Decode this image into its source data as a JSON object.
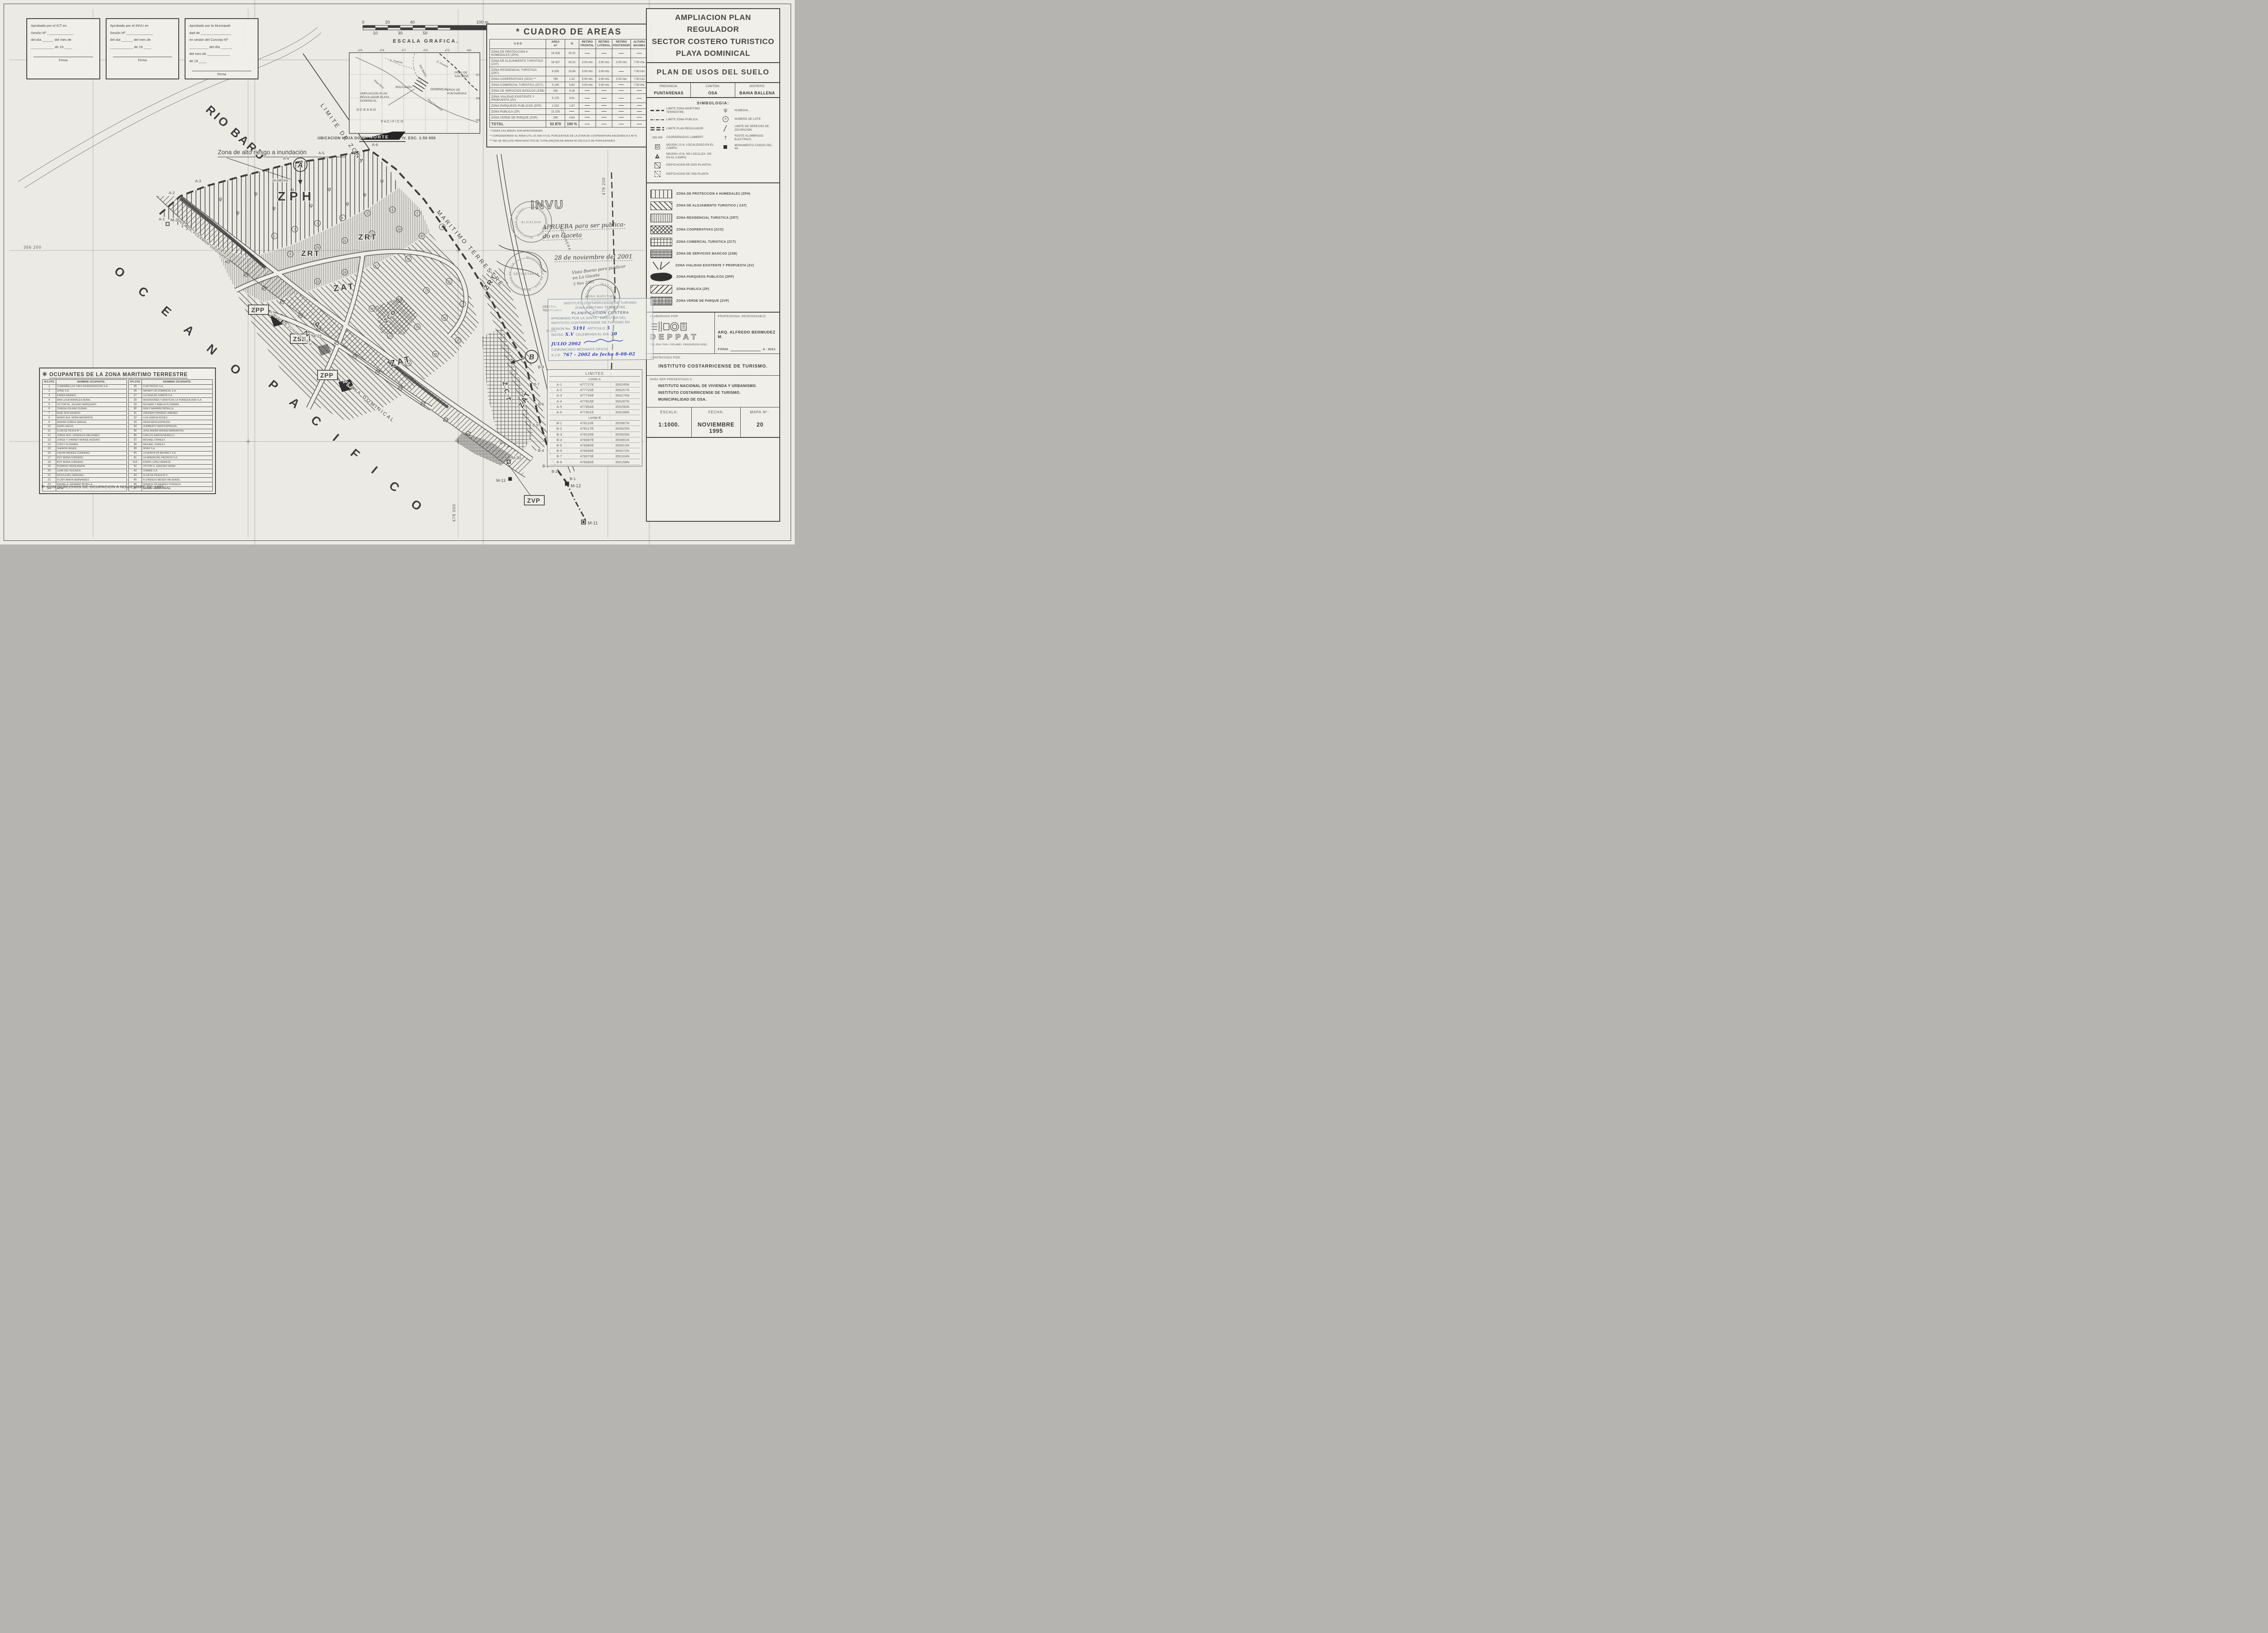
{
  "approval_boxes": [
    {
      "lines": [
        "Aprobado por el  ICT  en",
        "Sesión Nº ______________",
        "del día ______ del mes de",
        "____________ de 19 ____"
      ],
      "firma_label": "Firma"
    },
    {
      "lines": [
        "Aprobado por el INVU en",
        "Sesión Nº ______________",
        "del día ______ del mes de",
        "____________ de 19 ____"
      ],
      "firma_label": "Firma"
    },
    {
      "lines": [
        "Aprobado por la Municipali-",
        "dad de ________________",
        "en  sesión del Concejo Nº",
        "__________ del día ______",
        "del mes de ____________",
        "de 19 ____"
      ],
      "firma_label": "Firma"
    }
  ],
  "scale_bar": {
    "t0": "0",
    "t20": "20",
    "t40": "40",
    "t100": "100 m.",
    "b10": "10",
    "b30": "30",
    "b50": "50",
    "caption": "ESCALA  GRAFICA."
  },
  "north_label": "NORTE",
  "inset": {
    "caption": "UBICACION  HOJA  DOMINICAL  I.G.N.  3443 IV. ESC.  1:50 000",
    "grid_top": [
      "475",
      "476",
      "477",
      "478",
      "479",
      "480"
    ],
    "grid_right": [
      "357",
      "356",
      "355"
    ],
    "prov1a": "PROV  DE",
    "prov1b": "SAN  JOSE",
    "prov2a": "PROV  DE",
    "prov2b": "PUNTARENAS",
    "dominical": "DOMINICAL",
    "boca": "BOCA BARU",
    "rio": "RIO BARU",
    "q1": "Q. Tropiche",
    "q2": "Q. Esnaval",
    "playa": "Playa Dominical",
    "playa2": "Playa Baru",
    "callout1": "AMPLIACION  PLAN",
    "callout2": "REGULADOR  PLAYA",
    "callout3": "DOMINICAL",
    "oceano": "OCEANO",
    "pacifico": "PACIFICO"
  },
  "areas_table": {
    "title": "* CUADRO  DE  AREAS",
    "h_uso": "U S O",
    "h_area1": "AREA",
    "h_area2": "m²",
    "h_pct": "%",
    "h_r1a": "RETIRO",
    "h_r1b": "FRONTAL",
    "h_r2a": "RETIRO",
    "h_r2b": "LATERAL",
    "h_r3a": "RETIRO",
    "h_r3b": "POSTERIOR",
    "h_r4a": "ALTURA",
    "h_r4b": "MAXIMA",
    "rows": [
      [
        "ZONA DE PROTECCION A HUMEDALES (ZPH)",
        "16 328",
        "30.31",
        "-",
        "-",
        "-",
        "-"
      ],
      [
        "ZONA DE ALOJAMIENTO TURISTICO (ZAT)",
        "18 427",
        "34.21",
        "3.00 mts",
        "3.00 mts",
        "3.00 mts",
        "7.00 mts"
      ],
      [
        "ZONA RESIDENCIAL TURISTICA (ZRT)",
        "8 535",
        "15.84",
        "3.00 mts",
        "3.00 mts",
        "-",
        "7.00 mts"
      ],
      [
        "ZONA COOPERATIVAS (ZCO) **",
        "765",
        "1.42",
        "5.00 mts",
        "3.00 mts",
        "3.00 mts",
        "7.00 mts"
      ],
      [
        "ZONA COMERCIAL TURISTICA (ZCT).",
        "3 140",
        "5.83",
        "3.00 mts",
        "3.00 mts",
        "-",
        "7.00 mts"
      ],
      [
        "ZONA DE SERVICIOS BASICOS (ZSB)",
        "150",
        "0.28",
        "-",
        "-",
        "-",
        "-"
      ],
      [
        "ZONA VIALIDAD EXISTENTE Y PROPUESTA (ZV)",
        "5 175",
        "9.61",
        "-",
        "-",
        "-",
        "-"
      ],
      [
        "ZONA PARQUEOS PUBLICOS (ZPP)",
        "1 010",
        "1.87",
        "-",
        "-",
        "-",
        "-"
      ],
      [
        "ZONA PUBLICA (ZP)",
        "21 105",
        "-",
        "-",
        "-",
        "-",
        "-"
      ],
      [
        "ZONA VERDE DE PARQUE (ZVP)",
        "340",
        "0.63",
        "-",
        "-",
        "-",
        "-"
      ],
      [
        "TOTAL",
        "53 870",
        "100 %",
        "-",
        "-",
        "-",
        "-"
      ]
    ],
    "notes": [
      "*  TODAS LAS AREAS SON APROXIMADAS.",
      "**  CONSIDERANDO EL AREA UTIL (31 830 m²) EL PORCENTAJE DE LA ZONA DE COOPERATIVAS ASCIENDE A 2.40 %.",
      "***  NO SE INCLUYE PARA EFECTOS DE TOTALIZACION DE AREAS NI CALCULO DE PORCENTAJES."
    ]
  },
  "title_block": {
    "line1": "AMPLIACION PLAN REGULADOR",
    "line2": "SECTOR COSTERO TURISTICO",
    "line3": "PLAYA DOMINICAL",
    "subtitle": "PLAN  DE  USOS  DEL  SUELO",
    "prov_label": "PROVINCIA:",
    "prov": "PUNTARENAS",
    "canton_label": "CANTON:",
    "canton": "OSA",
    "distrito_label": "DISTRITO:",
    "distrito": "BAHIA BALLENA"
  },
  "simbologia": {
    "title": "SIMBOLOGIA:",
    "coordinate_sample": "356 200",
    "lot_number_sample": "4",
    "left": [
      {
        "sym": "zmt",
        "label": "LIMITE ZONA MARITIMO TERRESTRE."
      },
      {
        "sym": "zpub",
        "label": "LIMITE ZONA PUBLICA."
      },
      {
        "sym": "zpr",
        "label": "LIMITE PLAN REGULADOR."
      },
      {
        "sym": "coord",
        "label": "COORDENADAS LAMBERT."
      },
      {
        "sym": "mojon-loc",
        "label": "MOJON I.G.N. LOCALIZADO EN EL CAMPO."
      },
      {
        "sym": "mojon-noloc",
        "label": "MOJON I.G.N. NO LOCALIZA- DO EN EL CAMPO."
      },
      {
        "sym": "edif2",
        "label": "EDIFICACION DE DOS PLANTAS."
      },
      {
        "sym": "edif1",
        "label": "EDIFICACION DE UNA PLANTA"
      }
    ],
    "right": [
      {
        "sym": "humedal",
        "label": "HUMEDAL."
      },
      {
        "sym": "lote",
        "label": "NUMERO DE LOTE."
      },
      {
        "sym": "derecho",
        "label": "LIMITE DE DERECHO DE OCUPACION."
      },
      {
        "sym": "poste",
        "label": "POSTE ALUMBRADO ELECTRICO."
      },
      {
        "sym": "monu",
        "label": "MONUMENTO CAIDOS DEL 48."
      }
    ]
  },
  "zones_legend": [
    {
      "code": "zph",
      "label": "ZONA DE PROTECCION A HUMEDALES (ZPH)"
    },
    {
      "code": "zat",
      "label": "ZONA DE ALOJAMIENTO TURISTICO  ( ZAT)"
    },
    {
      "code": "zrt",
      "label": "ZONA RESIDENCIAL TURISTICA (ZRT)"
    },
    {
      "code": "zco",
      "label": "ZONA COOPERATIVAS (ZCO)"
    },
    {
      "code": "zct",
      "label": "ZONA COMERCIAL TURISTICA (ZCT)"
    },
    {
      "code": "zsb",
      "label": "ZONA DE SERVICIOS BASICOS (ZSB)"
    },
    {
      "code": "zv",
      "label": "ZONA VIALIDAD EXISTENTE Y PROPUESTA (ZV)"
    },
    {
      "code": "zpp",
      "label": "ZONA PARQUEOS PUBLICOS (ZPP)"
    },
    {
      "code": "zp",
      "label": "ZONA  PUBLICA (ZP)"
    },
    {
      "code": "zvp",
      "label": "ZONA VERDE DE PARQUE (ZVP)"
    }
  ],
  "credits": {
    "elaborado_label": "ELABORADO POR:",
    "brand": "DEPPAT",
    "tel": "TEL.224-7104 / 225-4881.  FAX(506)253-9282.",
    "responsable_label": "PROFESIONAL RESPONSABLE:",
    "responsable": "ARQ. ALFREDO BERMUDEZ M.",
    "firma_label": "FIRMA",
    "firma_code": "A - 4043.",
    "contratado_label": "CONTRATADO POR:",
    "contratado": "INSTITUTO  COSTARRICENSE  DE  TURISMO.",
    "presentado_label": "PARA SER PRESENTADO A:",
    "presentado": [
      "INSTITUTO NACIONAL DE VIVIENDA Y URBANISMO.",
      "INSTITUTO COSTARRICENSE DE TURISMO.",
      "MUNICIPALIDAD DE OSA."
    ],
    "escala_label": "ESCALA:",
    "escala": "1:1000.",
    "fecha_label": "FECHA:",
    "fecha": "NOVIEMBRE 1995",
    "mapa_label": "MAPA  Nº :",
    "mapa": "20"
  },
  "occupants": {
    "title": "OCUPANTES DE LA ZONA MARITIMO TERRESTRE",
    "star": "✳",
    "h_lote": "NºLOTE",
    "h_nombre": "NOMBRE  OCUPANTE:",
    "left": [
      [
        "1",
        "COMPAÑIA LOS TRES INVERSIONISTAS S.A."
      ],
      [
        "2",
        "SPIKE S.A."
      ],
      [
        "3",
        "KAREN EBANKS."
      ],
      [
        "4",
        "ANA LUCIA MORALES MORA."
      ],
      [
        "5",
        "VICTOR ML. SOLANO BARQUERO."
      ],
      [
        "6",
        "TERESA SOLANO DURAN."
      ],
      [
        "7",
        "ROEL BOS EKHAUD."
      ],
      [
        "8",
        "MARIO ALB. MORA MATARRITA."
      ],
      [
        "9",
        "ADRIAN ZUÑIGA VARGAS."
      ],
      [
        "10",
        "DENIS SACKS."
      ],
      [
        "11",
        "CLUB DE PESCA Nº 1."
      ],
      [
        "12",
        "JORGE EDO. GONZALEZ MELENDEZ"
      ],
      [
        "13",
        "JORGE Y VIANNEY MONGE AGÜERO."
      ],
      [
        "14",
        "STACY PLOWMEN."
      ],
      [
        "15",
        "SHERON WIGEN."
      ],
      [
        "16",
        "OSCAR MENDEZ CORDERO."
      ],
      [
        "17",
        "ROY MORA CORDERO."
      ],
      [
        "18",
        "ROY MORA CORDERO."
      ],
      [
        "19",
        "RODRIGO MORA ARAYA."
      ],
      [
        "20",
        "JUAN ZEC KUCHICH."
      ],
      [
        "21",
        "NICOLA ZEC SANCHEZ."
      ],
      [
        "22",
        "FLORY ARAYA HERNANDEZ."
      ],
      [
        "23",
        "RAFAEL A. NAVARRO BONILLA."
      ],
      [
        "24",
        "APSE."
      ]
    ],
    "right": [
      [
        "25",
        "FLEETWOOD S.A."
      ],
      [
        "26",
        "NAYARIT DE DOMINICAL S.A."
      ],
      [
        "27",
        "LA CASA DE JUANITA S.A."
      ],
      [
        "28",
        "INVERSIONES TURISTICAS LA TRANQUILIDAD S.A."
      ],
      [
        "29",
        "RICHARD Y AMELIA PLOWMAN."
      ],
      [
        "30",
        "SIDEY NAVARRO BONILLA."
      ],
      [
        "31",
        "VIRGINIA CORDERO JIMENEZ."
      ],
      [
        "32",
        "LUIS GARCIA ROSES."
      ],
      [
        "33",
        "ZAIDA  MATA ESPINOZA."
      ],
      [
        "34",
        "HUMBERTO MATA ESPINOZA."
      ],
      [
        "35",
        "JOSE ANDRE MONGE BARRANTES."
      ],
      [
        "36",
        "CARLOS GARCIA MURILLO."
      ],
      [
        "37",
        "MICHAEL STANLEY."
      ],
      [
        "38",
        "MICHAEL STANLEY."
      ],
      [
        "39",
        "SPIKE S.A."
      ],
      [
        "40",
        "LA QUINTA DE BEVERLY S.A."
      ],
      [
        "41",
        "LA SIRENA DEL PACIFICO S.A."
      ],
      [
        "41A",
        "EDWIN LOPEZ ARRIETA."
      ],
      [
        "42",
        "VICTOR H. SANCHEZ MORA"
      ],
      [
        "43",
        "COMIDE S.A."
      ],
      [
        "44",
        "CLUB DE PESCA Nº 2."
      ],
      [
        "45",
        "FLORENCIO MESEN VALVERDE."
      ],
      [
        "46",
        "DIANA FLOR MENDEZ FONSECA."
      ],
      [
        "47",
        "RAFAEL UREÑA UREÑA."
      ]
    ],
    "footnote": "CON DERECHOS DE OCUPACION A NOVIEMBRE DE 1995."
  },
  "limits": {
    "title": "LIMITES",
    "a_label": "Limite A",
    "a_rows": [
      [
        "A-1",
        "477727E",
        "356245N"
      ],
      [
        "A-2",
        "477720E",
        "356257N"
      ],
      [
        "A-3",
        "477734E",
        "356270N"
      ],
      [
        "A-4",
        "477816E",
        "356287N"
      ],
      [
        "A-5",
        "477854E",
        "356290N"
      ],
      [
        "A-6",
        "477901E",
        "356298N"
      ]
    ],
    "b_label": "Limite B",
    "b_rows": [
      [
        "B-1",
        "478116E",
        "355967N"
      ],
      [
        "B-2",
        "478117E",
        "355925N"
      ],
      [
        "B-3",
        "478100E",
        "355926N"
      ],
      [
        "B-4",
        "478087E",
        "355991N"
      ],
      [
        "B-5",
        "478080E",
        "356013N"
      ],
      [
        "B-6",
        "478068E",
        "356072N"
      ],
      [
        "B-7",
        "478070E",
        "356104N"
      ],
      [
        "B-8",
        "478085E",
        "356158N"
      ]
    ]
  },
  "stamps": {
    "invu": "INVU",
    "hand_line1": "APRUEBA  para  ser  publica-",
    "hand_line2": "do  en  Gaceta",
    "hand_line3": "28  de noviembre del 2001",
    "visto1": "Visto Bueno para publicar",
    "visto2": "en La Gaceta",
    "visto_date": "5 Nov 2001",
    "ict_ring": "INSTITUTO COSTARRICENSE DE TURISMO ·",
    "ict_c1": "ZONA MARITIMO",
    "ict_c2": "TERRESTRE",
    "muni_ring1": "Municipalidad de Osa · Municipalidad de Osa ·",
    "muni_c1": "ALCALDIA",
    "muni_ring2": "Municipalidad de Osa · Municipalidad de Osa ·",
    "muni_c2": "SECRETARIA",
    "blue_l1": "INSTITUTO COSTARRICENSE DE TURISMO",
    "blue_l2": "ZONA MARITIMO TERRESTRE",
    "blue_l3": "PLANIFICACION  COSTERA",
    "blue_l4": "APROBADO  POR  LA  JUNTA · DIRECTIVA  DEL",
    "blue_l5": "INSTITUTO COSTARRICENSE DE TURISMO EN",
    "sesion_label": "SESION No.",
    "sesion_value": "5191",
    "articulo_label": "ARTICULO",
    "articulo_value": "5",
    "inciso_label": "INCISO",
    "inciso_value": "X.V",
    "celebrada_label": "CELEBRADA EL DIA",
    "celebrada_value": "30",
    "mes_value": "JULIO 2002",
    "blue_l9": "COMUNICADO  MEDIANTE  OFICIO",
    "sjd_label": "S.J.D.",
    "sjd_value": "767 - 2002  de fecha 8-08-02",
    "central1": "CENTRAL",
    "central2": "TELEFONICA",
    "torre": "TORRE",
    "costanera": "COSTANERA"
  },
  "map": {
    "rio_baru": "RIO BARU",
    "oceano": "O C E A N O",
    "pacifico": "P A C I F I C O",
    "zph": "ZPH",
    "humedal": "HUMEDAL",
    "humedal_glyph": "ψ",
    "zrt1": "ZRT",
    "zrt2": "ZRT",
    "zrt3": "ZRT",
    "zat1": "ZAT",
    "zat2": "ZAT",
    "zat3": "ZAT",
    "zco": "ZCO",
    "zct": "Z C T",
    "zp": "Z P",
    "zsb": "ZSB",
    "zpp1": "ZPP",
    "zpp2": "ZPP",
    "zvp": "ZVP",
    "flood_note": "Zona de alto riesgo a inundación",
    "limite_zona": "LIMITE  DE  ZONA",
    "maritimo_terrestre": "MARITIMO  TERRESTRE",
    "linea_pleamar": "LINEA DE PLEAMAR ORDINARIA",
    "limite_zona_publica": "LIMITE DE ZONA PUBLICA",
    "playa_dominical": "PLAYA   DOMINICAL",
    "marker_a": "A",
    "marker_b": "B",
    "a1": "A-1",
    "a2": "A-2",
    "a3": "A-3",
    "a4": "A-4",
    "a5": "A-5",
    "a6": "A-6",
    "b1": "B-1",
    "b2": "B-2",
    "b3": "B-3",
    "b4": "B-4",
    "b5": "B-5",
    "b6": "B-6",
    "b7": "B-7",
    "b8": "B-8",
    "m35": "M-35",
    "m33": "M-33",
    "m30": "M-30",
    "m13": "M-13",
    "m12": "M-12",
    "m11": "M-11",
    "g477600": "477 600",
    "g477800": "477 800",
    "g478000": "478 000",
    "g478200": "478 200",
    "g356400": "356 400",
    "g356200": "356 200",
    "g356000": "356 000",
    "lot_numbers": [
      "1",
      "2",
      "3",
      "4",
      "5",
      "6",
      "7",
      "8",
      "9",
      "10",
      "11",
      "12",
      "13",
      "14",
      "15",
      "16",
      "17",
      "18",
      "19",
      "20",
      "21",
      "22",
      "24",
      "25",
      "26",
      "27",
      "28",
      "29",
      "31"
    ]
  }
}
